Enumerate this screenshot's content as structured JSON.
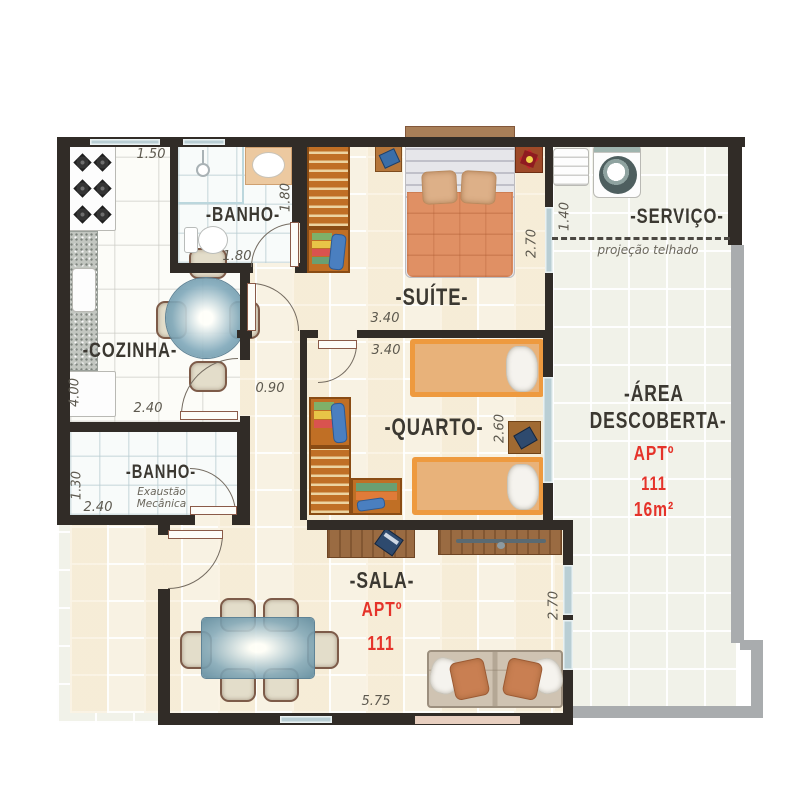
{
  "plan": {
    "banho1": {
      "label": "-BANHO-",
      "dim_top": "1.50",
      "dim_right": "1.80",
      "dim_bottom": "1.80"
    },
    "cozinha": {
      "label": "-COZINHA-",
      "dim_left": "4.00",
      "dim_bottom": "2.40"
    },
    "suite": {
      "label": "-SUÍTE-",
      "dim_bottom": "3.40",
      "dim_right": "2.70"
    },
    "servico": {
      "label": "-SERVIÇO-",
      "dim_left": "1.40",
      "roof_note": "projeção telhado"
    },
    "hall": {
      "dim": "0.90"
    },
    "quarto": {
      "label": "-QUARTO-",
      "dim_top": "3.40",
      "dim_right": "2.60"
    },
    "banho2": {
      "label": "-BANHO-",
      "note": "Exaustão Mecânica",
      "dim_left": "1.30",
      "dim_bottom": "2.40"
    },
    "sala": {
      "label": "-SALA-",
      "apt": "APTº",
      "number": "111",
      "dim_bottom": "5.75",
      "dim_right": "2.70"
    },
    "area_descoberta": {
      "label_line1": "-ÁREA",
      "label_line2": "DESCOBERTA-",
      "apt": "APTº",
      "number": "111",
      "size": "16m²"
    }
  },
  "colors": {
    "wall_black": "#312c27",
    "wall_outdoor_gray": "#a9acae",
    "accent_red": "#e5332a",
    "label_dark": "#3b3831",
    "floor_cream": "#f8f2e3",
    "floor_pale": "#f1f2e9",
    "window_blue": "#b9ced4"
  }
}
